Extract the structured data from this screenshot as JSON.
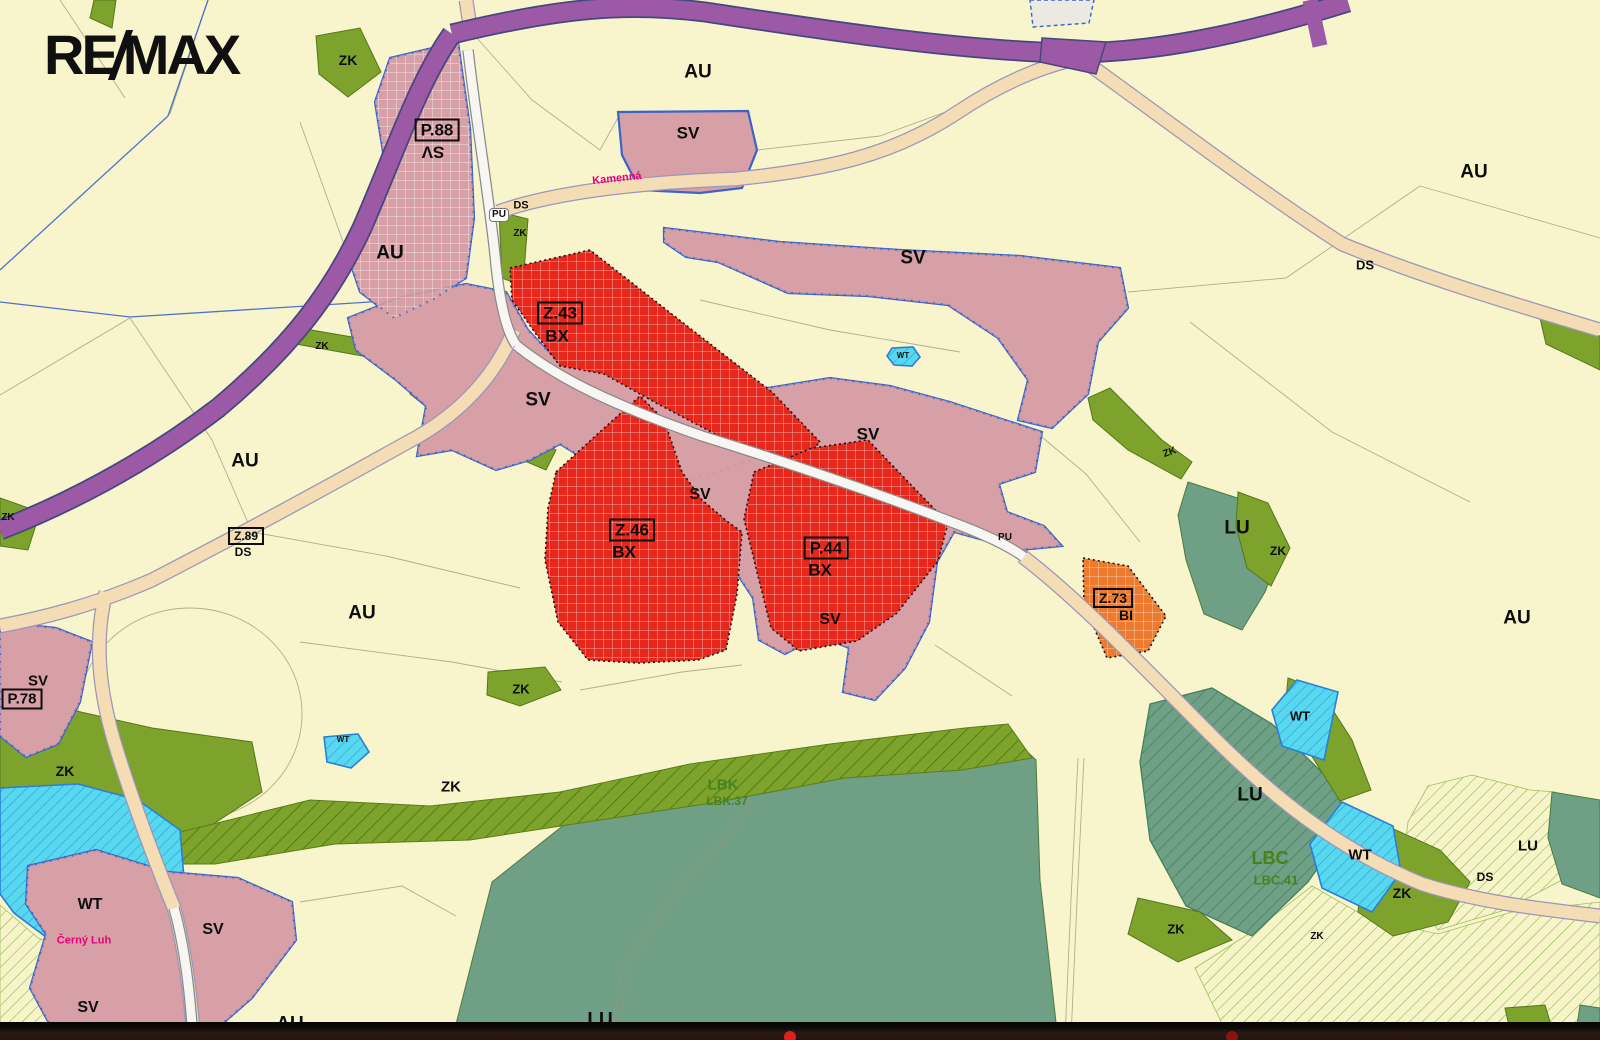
{
  "logo": {
    "part1": "RE",
    "part2": "MAX"
  },
  "palette": {
    "cream": "#f8f5cd",
    "sv_pink": "#d79fa6",
    "sv_border": "#3a64c8",
    "bx_red": "#e8271c",
    "bi_orange": "#ee7a2d",
    "zk_green": "#7ea32c",
    "lu_green": "#6f9f85",
    "wt_cyan": "#58d7f1",
    "wt_border": "#2a7fd4",
    "road_purple": "#9c59a5",
    "road_purple_edge": "#47477f",
    "road_tan": "#f4dcb4",
    "road_white": "#f8f6f2",
    "parcel_line": "#9a9776",
    "label": "#0d0d0d",
    "eco_label": "#47821c",
    "street_label": "#e5007e",
    "bar": "#2a1a12",
    "logo": "#101010",
    "hatch_pale_line": "#86b544",
    "lbk_line": "#4c7a10",
    "lbc_line": "#42805c",
    "red_dot": "#e02020"
  },
  "labels": {
    "zones": [
      {
        "text": "ZK",
        "x": 348,
        "y": 60,
        "s": 14
      },
      {
        "text": "AU",
        "x": 698,
        "y": 72,
        "s": 19
      },
      {
        "text": "AU",
        "x": 1474,
        "y": 172,
        "s": 19
      },
      {
        "text": "SV",
        "x": 688,
        "y": 133,
        "s": 17
      },
      {
        "text": "DS",
        "x": 521,
        "y": 206,
        "s": 11
      },
      {
        "text": "PU",
        "x": 499,
        "y": 215,
        "s": 10,
        "cls": "badge"
      },
      {
        "text": "ZK",
        "x": 520,
        "y": 234,
        "s": 10
      },
      {
        "text": "AU",
        "x": 390,
        "y": 253,
        "s": 19
      },
      {
        "text": "SV",
        "x": 913,
        "y": 258,
        "s": 19
      },
      {
        "text": "DS",
        "x": 1365,
        "y": 265,
        "s": 13
      },
      {
        "text": "ZK",
        "x": 322,
        "y": 347,
        "s": 10
      },
      {
        "text": "WT",
        "x": 903,
        "y": 356,
        "s": 8
      },
      {
        "text": "SV",
        "x": 538,
        "y": 400,
        "s": 19
      },
      {
        "text": "SV",
        "x": 868,
        "y": 434,
        "s": 17
      },
      {
        "text": "ZK",
        "x": 1170,
        "y": 453,
        "s": 10,
        "rot": -20
      },
      {
        "text": "AU",
        "x": 245,
        "y": 461,
        "s": 19
      },
      {
        "text": "SV",
        "x": 700,
        "y": 495,
        "s": 16
      },
      {
        "text": "ZK",
        "x": 8,
        "y": 518,
        "s": 10
      },
      {
        "text": "LU",
        "x": 1237,
        "y": 528,
        "s": 19
      },
      {
        "text": "PU",
        "x": 1005,
        "y": 538,
        "s": 10
      },
      {
        "text": "ZK",
        "x": 1278,
        "y": 551,
        "s": 12
      },
      {
        "text": "AU",
        "x": 362,
        "y": 613,
        "s": 19
      },
      {
        "text": "AU",
        "x": 1517,
        "y": 618,
        "s": 19
      },
      {
        "text": "SV",
        "x": 830,
        "y": 620,
        "s": 16
      },
      {
        "text": "ZK",
        "x": 521,
        "y": 689,
        "s": 13
      },
      {
        "text": "WT",
        "x": 1300,
        "y": 716,
        "s": 13
      },
      {
        "text": "WT",
        "x": 343,
        "y": 740,
        "s": 8
      },
      {
        "text": "ZK",
        "x": 65,
        "y": 771,
        "s": 14
      },
      {
        "text": "LBK",
        "x": 723,
        "y": 785,
        "s": 15,
        "cls": "green"
      },
      {
        "text": "ZK",
        "x": 451,
        "y": 787,
        "s": 15
      },
      {
        "text": "LU",
        "x": 1250,
        "y": 795,
        "s": 19
      },
      {
        "text": "LBK.37",
        "x": 727,
        "y": 801,
        "s": 12,
        "cls": "green"
      },
      {
        "text": "LU",
        "x": 1528,
        "y": 846,
        "s": 15
      },
      {
        "text": "WT",
        "x": 1360,
        "y": 855,
        "s": 15
      },
      {
        "text": "LBC",
        "x": 1270,
        "y": 858,
        "s": 18,
        "cls": "green"
      },
      {
        "text": "DS",
        "x": 1485,
        "y": 877,
        "s": 12
      },
      {
        "text": "LBC.41",
        "x": 1276,
        "y": 880,
        "s": 13,
        "cls": "green"
      },
      {
        "text": "ZK",
        "x": 1402,
        "y": 893,
        "s": 14
      },
      {
        "text": "WT",
        "x": 90,
        "y": 905,
        "s": 16
      },
      {
        "text": "ZK",
        "x": 1176,
        "y": 929,
        "s": 13
      },
      {
        "text": "SV",
        "x": 213,
        "y": 930,
        "s": 16
      },
      {
        "text": "ZK",
        "x": 1317,
        "y": 937,
        "s": 10
      },
      {
        "text": "SV",
        "x": 88,
        "y": 1008,
        "s": 16
      },
      {
        "text": "LU",
        "x": 600,
        "y": 1020,
        "s": 19
      },
      {
        "text": "AU",
        "x": 290,
        "y": 1024,
        "s": 19
      }
    ],
    "boxed": [
      {
        "box": "P.88",
        "sub": "SV",
        "x": 437,
        "y": 130,
        "subx": 433,
        "suby": 152,
        "s": 17,
        "subrot": 180
      },
      {
        "box": "Z.43",
        "sub": "BX",
        "x": 560,
        "y": 313,
        "subx": 557,
        "suby": 336,
        "s": 17
      },
      {
        "box": "Z.89",
        "sub": "DS",
        "x": 246,
        "y": 536,
        "subx": 243,
        "suby": 552,
        "s": 12
      },
      {
        "box": "Z.46",
        "sub": "BX",
        "x": 632,
        "y": 530,
        "subx": 624,
        "suby": 552,
        "s": 17
      },
      {
        "box": "P.44",
        "sub": "BX",
        "x": 826,
        "y": 548,
        "subx": 820,
        "suby": 570,
        "s": 17
      },
      {
        "box": "Z.73",
        "sub": "BI",
        "x": 1113,
        "y": 598,
        "subx": 1126,
        "suby": 615,
        "s": 14
      },
      {
        "box": "P.78",
        "sub": "SV",
        "x": 22,
        "y": 699,
        "subx": 38,
        "suby": 681,
        "s": 15
      }
    ],
    "streets": [
      {
        "text": "Kamenná",
        "x": 617,
        "y": 179,
        "s": 11,
        "rot": -6
      },
      {
        "text": "Černý Luh",
        "x": 84,
        "y": 941,
        "s": 11
      }
    ]
  }
}
